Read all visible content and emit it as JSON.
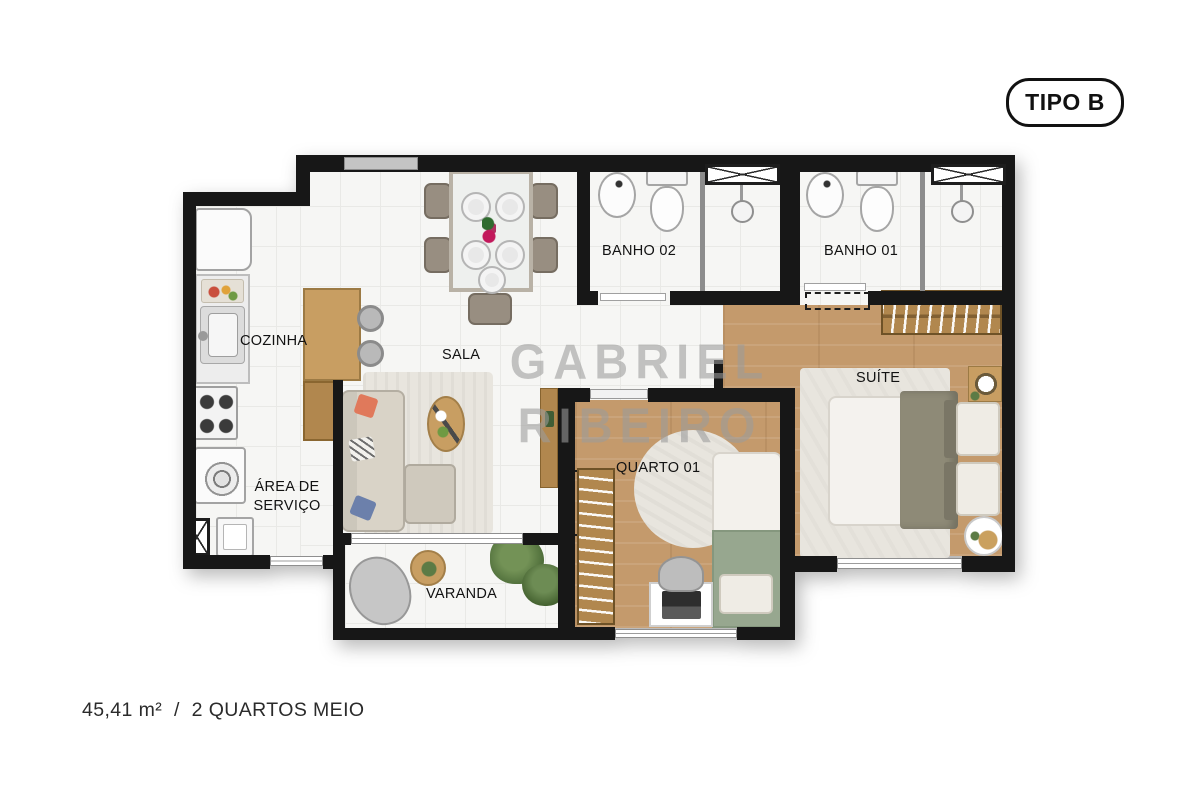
{
  "badge": {
    "label": "TIPO B"
  },
  "watermark": {
    "line1": "GABRIEL",
    "line2": "RIBEIRO"
  },
  "caption": {
    "area": "45,41 m²",
    "separator": "/",
    "description": "2 QUARTOS MEIO"
  },
  "rooms": {
    "cozinha": {
      "label": "COZINHA"
    },
    "sala": {
      "label": "SALA"
    },
    "banho02": {
      "label": "BANHO 02"
    },
    "banho01": {
      "label": "BANHO 01"
    },
    "suite": {
      "label": "SUÍTE"
    },
    "quarto01": {
      "label": "QUARTO 01"
    },
    "area_servico": {
      "line1": "ÁREA DE",
      "line2": "SERVIÇO"
    },
    "varanda": {
      "label": "VARANDA"
    }
  },
  "colors": {
    "wall": "#171717",
    "tile_bg": "#f6f6f4",
    "tile_line": "#e9e9e6",
    "wood_floor": "#c49a6c",
    "wardrobe_wood": "#b1874e",
    "counter_wood": "#c89e62",
    "rug": "#e8e5de",
    "sofa": "#d9d3c7",
    "cushion_coral": "#e0795b",
    "cushion_blue": "#6c80ab",
    "bed_green": "#97a78f",
    "suite_blanket": "#8e8a77",
    "plant": "#5c7b45",
    "watermark": "#9c9c9c",
    "label": "#121212",
    "caption": "#2b2b2b"
  }
}
